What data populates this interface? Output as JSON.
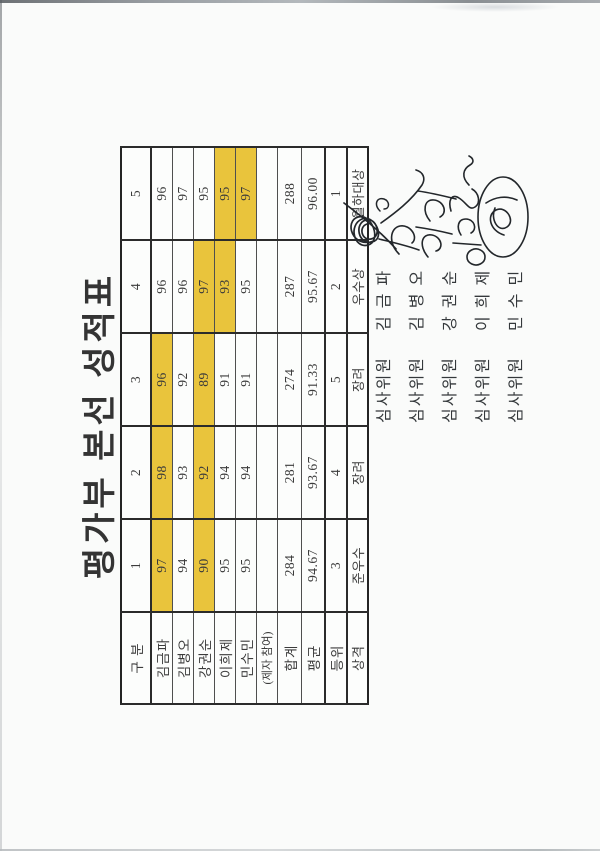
{
  "title": "평가부 본선 성적표",
  "colors": {
    "paper": "#fafbfa",
    "highlight": "#e9c43c",
    "table_line": "#2b2b2b",
    "ink": "#3b3b3b"
  },
  "score_table": {
    "corner_label": "구 분",
    "contestant_columns": [
      "1",
      "2",
      "3",
      "4",
      "5"
    ],
    "judge_rows": [
      {
        "label": "김금파",
        "scores": [
          "97",
          "98",
          "96",
          "96",
          "96"
        ],
        "highlighted": [
          true,
          true,
          true,
          false,
          false
        ]
      },
      {
        "label": "김병오",
        "scores": [
          "94",
          "93",
          "92",
          "96",
          "97"
        ],
        "highlighted": [
          false,
          false,
          false,
          false,
          false
        ]
      },
      {
        "label": "강권순",
        "scores": [
          "90",
          "92",
          "89",
          "97",
          "95"
        ],
        "highlighted": [
          true,
          true,
          true,
          true,
          false
        ]
      },
      {
        "label": "이희제",
        "scores": [
          "95",
          "94",
          "91",
          "93",
          "95"
        ],
        "highlighted": [
          false,
          false,
          false,
          true,
          true
        ]
      },
      {
        "label": "민수민",
        "scores": [
          "95",
          "94",
          "91",
          "95",
          "97"
        ],
        "highlighted": [
          false,
          false,
          false,
          false,
          true
        ]
      }
    ],
    "disciple_row": {
      "label": "(제자 참여)",
      "values": [
        "",
        "",
        "",
        "",
        ""
      ]
    },
    "summary_rows": [
      {
        "label": "합계",
        "values": [
          "284",
          "281",
          "274",
          "287",
          "288"
        ]
      },
      {
        "label": "평균",
        "values": [
          "94.67",
          "93.67",
          "91.33",
          "95.67",
          "96.00"
        ]
      },
      {
        "label": "등위",
        "values": [
          "3",
          "4",
          "5",
          "2",
          "1"
        ]
      },
      {
        "label": "상격",
        "values": [
          "준우수",
          "장려",
          "장려",
          "우수상",
          "월하대상"
        ]
      }
    ]
  },
  "signatures": [
    {
      "role": "심사위원",
      "name": "김 금 파"
    },
    {
      "role": "심사위원",
      "name": "김 병 오"
    },
    {
      "role": "심사위원",
      "name": "강 권 순"
    },
    {
      "role": "심사위원",
      "name": "이 희 제"
    },
    {
      "role": "심사위원",
      "name": "민 수 민"
    }
  ]
}
